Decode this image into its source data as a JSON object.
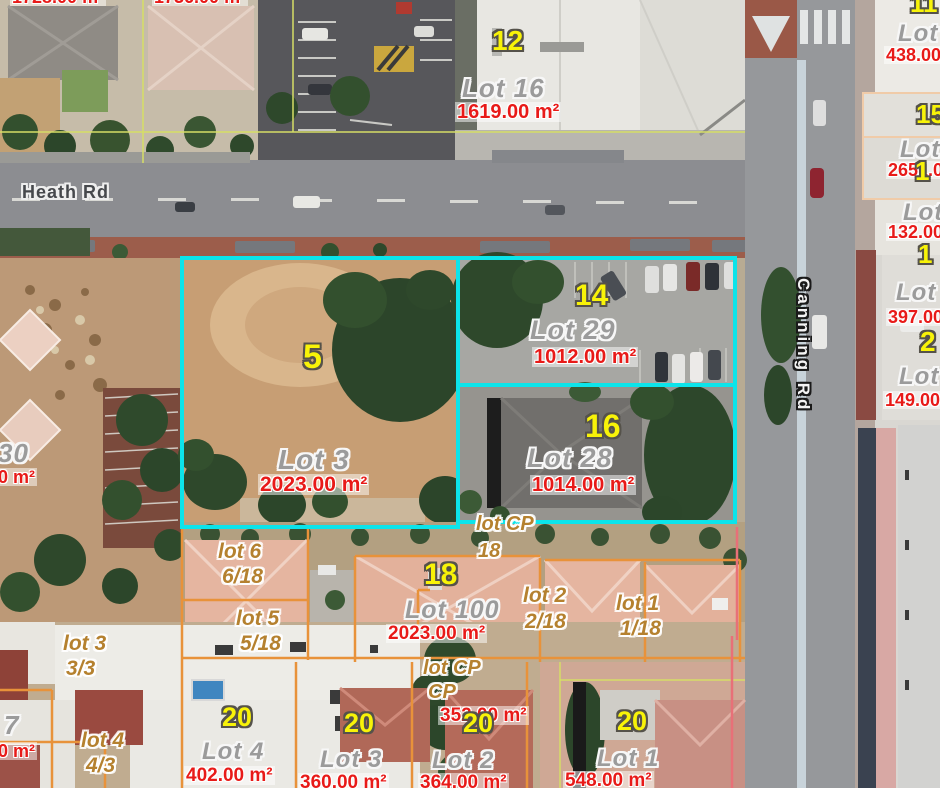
{
  "map": {
    "street_names": [
      "Heath Rd",
      "Canning Rd"
    ],
    "colors": {
      "parcel_highlight_cyan": "#0ce4ea",
      "lot_boundary_orange": "#e8923a",
      "boundary_pink": "#e87078",
      "boundary_yellowgreen": "#d6de66",
      "boundary_peach": "#f0cba8",
      "street_number_yellow": "#f8f308",
      "lot_name_gray": "#9b9b9b",
      "area_red": "#e81a18",
      "strata_text_orange": "#b5812f"
    },
    "highlighted_parcels": [
      {
        "street_no": "5",
        "lot": "Lot 3",
        "area": "2023.00 m²"
      },
      {
        "street_no": "14",
        "lot": "Lot 29",
        "area": "1012.00 m²"
      },
      {
        "street_no": "16",
        "lot": "Lot 28",
        "area": "1014.00 m²"
      }
    ]
  },
  "labels": [
    {
      "t": "Heath Rd",
      "k": "sh",
      "x": 22,
      "y": 183,
      "fs": 18
    },
    {
      "t": "Canning Rd",
      "k": "sv",
      "x": 812,
      "y": 278,
      "fs": 17
    },
    {
      "t": "12",
      "k": "num",
      "x": 492,
      "y": 27,
      "fs": 28
    },
    {
      "t": "5",
      "k": "num",
      "x": 303,
      "y": 340,
      "fs": 34
    },
    {
      "t": "14",
      "k": "num",
      "x": 575,
      "y": 281,
      "fs": 30
    },
    {
      "t": "16",
      "k": "num",
      "x": 585,
      "y": 410,
      "fs": 32
    },
    {
      "t": "18",
      "k": "num",
      "x": 424,
      "y": 560,
      "fs": 30
    },
    {
      "t": "20",
      "k": "num",
      "x": 222,
      "y": 704,
      "fs": 27
    },
    {
      "t": "20",
      "k": "num",
      "x": 344,
      "y": 710,
      "fs": 27
    },
    {
      "t": "20",
      "k": "num",
      "x": 463,
      "y": 710,
      "fs": 27
    },
    {
      "t": "20",
      "k": "num",
      "x": 617,
      "y": 708,
      "fs": 27
    },
    {
      "t": "11",
      "k": "num",
      "x": 910,
      "y": -10,
      "fs": 26
    },
    {
      "t": "15",
      "k": "num",
      "x": 916,
      "y": 101,
      "fs": 26
    },
    {
      "t": "1",
      "k": "num",
      "x": 915,
      "y": 158,
      "fs": 26
    },
    {
      "t": "1",
      "k": "num",
      "x": 918,
      "y": 241,
      "fs": 26
    },
    {
      "t": "2",
      "k": "num",
      "x": 920,
      "y": 328,
      "fs": 28
    },
    {
      "t": "Lot 16",
      "k": "lot",
      "x": 462,
      "y": 75,
      "fs": 26
    },
    {
      "t": "Lot 3",
      "k": "lot",
      "x": 278,
      "y": 446,
      "fs": 28
    },
    {
      "t": "Lot 29",
      "k": "lot",
      "x": 530,
      "y": 317,
      "fs": 27
    },
    {
      "t": "Lot 28",
      "k": "lot",
      "x": 527,
      "y": 445,
      "fs": 27
    },
    {
      "t": "Lot 100",
      "k": "lot",
      "x": 405,
      "y": 598,
      "fs": 25
    },
    {
      "t": "Lot 4",
      "k": "lot",
      "x": 202,
      "y": 740,
      "fs": 24
    },
    {
      "t": "Lot 3",
      "k": "lot",
      "x": 320,
      "y": 748,
      "fs": 24
    },
    {
      "t": "Lot 2",
      "k": "lot",
      "x": 432,
      "y": 749,
      "fs": 24
    },
    {
      "t": "Lot 1",
      "k": "lot",
      "x": 597,
      "y": 747,
      "fs": 24
    },
    {
      "t": "30",
      "k": "lot",
      "x": -2,
      "y": 440,
      "fs": 26
    },
    {
      "t": "7",
      "k": "lot",
      "x": 4,
      "y": 712,
      "fs": 26
    },
    {
      "t": "Lot",
      "k": "lot",
      "x": 898,
      "y": 22,
      "fs": 24
    },
    {
      "t": "Lot",
      "k": "lot",
      "x": 900,
      "y": 138,
      "fs": 24
    },
    {
      "t": "Lot",
      "k": "lot",
      "x": 903,
      "y": 201,
      "fs": 24
    },
    {
      "t": "Lot",
      "k": "lot",
      "x": 896,
      "y": 281,
      "fs": 24
    },
    {
      "t": "Lot",
      "k": "lot",
      "x": 899,
      "y": 365,
      "fs": 24
    },
    {
      "t": "1619.00 m²",
      "k": "area",
      "x": 455,
      "y": 102,
      "fs": 20
    },
    {
      "t": "2023.00 m²",
      "k": "area",
      "x": 258,
      "y": 474,
      "fs": 21
    },
    {
      "t": "1012.00 m²",
      "k": "area",
      "x": 532,
      "y": 347,
      "fs": 20
    },
    {
      "t": "1014.00 m²",
      "k": "area",
      "x": 530,
      "y": 475,
      "fs": 20
    },
    {
      "t": "2023.00 m²",
      "k": "area",
      "x": 386,
      "y": 624,
      "fs": 19
    },
    {
      "t": "402.00 m²",
      "k": "area",
      "x": 184,
      "y": 766,
      "fs": 19
    },
    {
      "t": "360.00 m²",
      "k": "area",
      "x": 298,
      "y": 773,
      "fs": 19
    },
    {
      "t": "364.00 m²",
      "k": "area",
      "x": 418,
      "y": 773,
      "fs": 19
    },
    {
      "t": "548.00 m²",
      "k": "area",
      "x": 563,
      "y": 771,
      "fs": 19
    },
    {
      "t": "352.00 m²",
      "k": "area",
      "x": 438,
      "y": 706,
      "fs": 19
    },
    {
      "t": "1728.00 m²",
      "k": "area",
      "x": 10,
      "y": -12,
      "fs": 18
    },
    {
      "t": "1736.00 m²",
      "k": "area",
      "x": 152,
      "y": -12,
      "fs": 18
    },
    {
      "t": "438.00 m²",
      "k": "area",
      "x": 884,
      "y": 46,
      "fs": 18
    },
    {
      "t": "2651.00 m²",
      "k": "area",
      "x": 886,
      "y": 161,
      "fs": 18
    },
    {
      "t": "132.00 m²",
      "k": "area",
      "x": 886,
      "y": 223,
      "fs": 18
    },
    {
      "t": "397.00 m²",
      "k": "area",
      "x": 886,
      "y": 308,
      "fs": 18
    },
    {
      "t": "149.00 m²",
      "k": "area",
      "x": 883,
      "y": 391,
      "fs": 18
    },
    {
      "t": "0 m²",
      "k": "area",
      "x": -4,
      "y": 468,
      "fs": 18
    },
    {
      "t": "0 m²",
      "k": "area",
      "x": -4,
      "y": 742,
      "fs": 18
    },
    {
      "t": "lot 6",
      "k": "strata",
      "x": 218,
      "y": 541,
      "fs": 21
    },
    {
      "t": "6/18",
      "k": "strata",
      "x": 222,
      "y": 566,
      "fs": 21
    },
    {
      "t": "lot 5",
      "k": "strata",
      "x": 236,
      "y": 608,
      "fs": 21
    },
    {
      "t": "5/18",
      "k": "strata",
      "x": 240,
      "y": 633,
      "fs": 21
    },
    {
      "t": "lot CP",
      "k": "strata",
      "x": 476,
      "y": 514,
      "fs": 20
    },
    {
      "t": "18",
      "k": "strata",
      "x": 478,
      "y": 541,
      "fs": 20
    },
    {
      "t": "lot 2",
      "k": "strata",
      "x": 523,
      "y": 585,
      "fs": 21
    },
    {
      "t": "2/18",
      "k": "strata",
      "x": 525,
      "y": 611,
      "fs": 21
    },
    {
      "t": "lot 1",
      "k": "strata",
      "x": 616,
      "y": 593,
      "fs": 21
    },
    {
      "t": "1/18",
      "k": "strata",
      "x": 620,
      "y": 618,
      "fs": 21
    },
    {
      "t": "lot CP",
      "k": "strata",
      "x": 423,
      "y": 658,
      "fs": 20
    },
    {
      "t": "CP",
      "k": "strata",
      "x": 428,
      "y": 682,
      "fs": 20
    },
    {
      "t": "lot 3",
      "k": "strata",
      "x": 63,
      "y": 633,
      "fs": 21
    },
    {
      "t": "3/3",
      "k": "strata",
      "x": 66,
      "y": 658,
      "fs": 21
    },
    {
      "t": "lot 4",
      "k": "strata",
      "x": 81,
      "y": 730,
      "fs": 21
    },
    {
      "t": "4/3",
      "k": "strata",
      "x": 86,
      "y": 755,
      "fs": 21
    }
  ]
}
